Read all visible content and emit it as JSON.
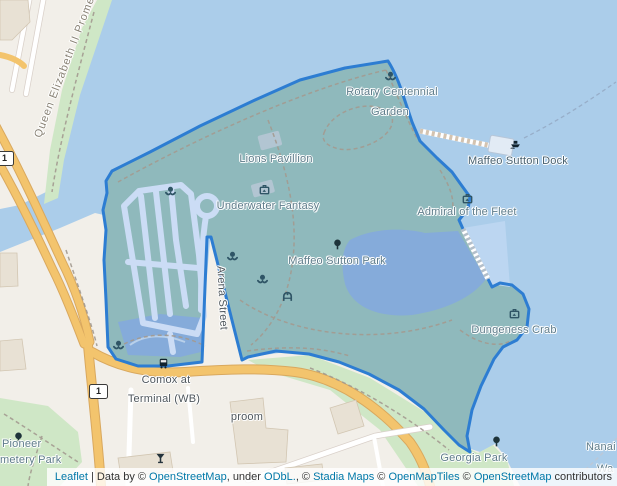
{
  "map": {
    "description": "Leaflet web map of Maffeo Sutton Park, Nanaimo, with park polygon highlighted",
    "colors": {
      "park_boundary": "#2D7DD2",
      "park_fill": "#8FB9BC",
      "sea": "#ABCDEA",
      "lagoon": "#85ABDA",
      "road_orange": "#F3C46D",
      "green_area": "#CFE7C6",
      "land": "#F2EFE9",
      "link_blue": "#0078A8"
    },
    "labels": {
      "rotary_line1": "Rotary Centennial",
      "rotary_line2": "Garden",
      "lions_pavillion": "Lions Pavillion",
      "underwater_fantasy": "Underwater Fantasy",
      "maffeo_sutton_park": "Maffeo Sutton Park",
      "admiral_of_the_fleet": "Admiral of the Fleet",
      "maffeo_sutton_dock": "Maffeo Sutton Dock",
      "dungeness_crab": "Dungeness Crab",
      "georgia_park": "Georgia Park",
      "comox_stop_line1": "Comox at",
      "comox_stop_line2": "Terminal (WB)",
      "taproom_partial": "proom",
      "pioneer_line1": "Pioneer",
      "pioneer_line2": "metery Park",
      "nanaimo_partial_line1": "Nanai",
      "nanaimo_partial_line2": "Wa",
      "arena_street": "Arena Street",
      "promenade": "Queen Elizabeth II Promen",
      "highway_shield": "1"
    },
    "icons": [
      "flower-icon",
      "artwork-icon",
      "playground-icon",
      "tree-icon",
      "bus-stop-icon",
      "boat-dock-icon",
      "bar-icon"
    ]
  },
  "attribution": {
    "segments": [
      {
        "text": "Leaflet",
        "link": true
      },
      {
        "text": " | Data by © ",
        "link": false
      },
      {
        "text": "OpenStreetMap",
        "link": true
      },
      {
        "text": ", under ",
        "link": false
      },
      {
        "text": "ODbL.",
        "link": true
      },
      {
        "text": ", © ",
        "link": false
      },
      {
        "text": "Stadia Maps",
        "link": true
      },
      {
        "text": " © ",
        "link": false
      },
      {
        "text": "OpenMapTiles",
        "link": true
      },
      {
        "text": " © ",
        "link": false
      },
      {
        "text": "OpenStreetMap",
        "link": true
      },
      {
        "text": " contributors",
        "link": false
      }
    ]
  }
}
